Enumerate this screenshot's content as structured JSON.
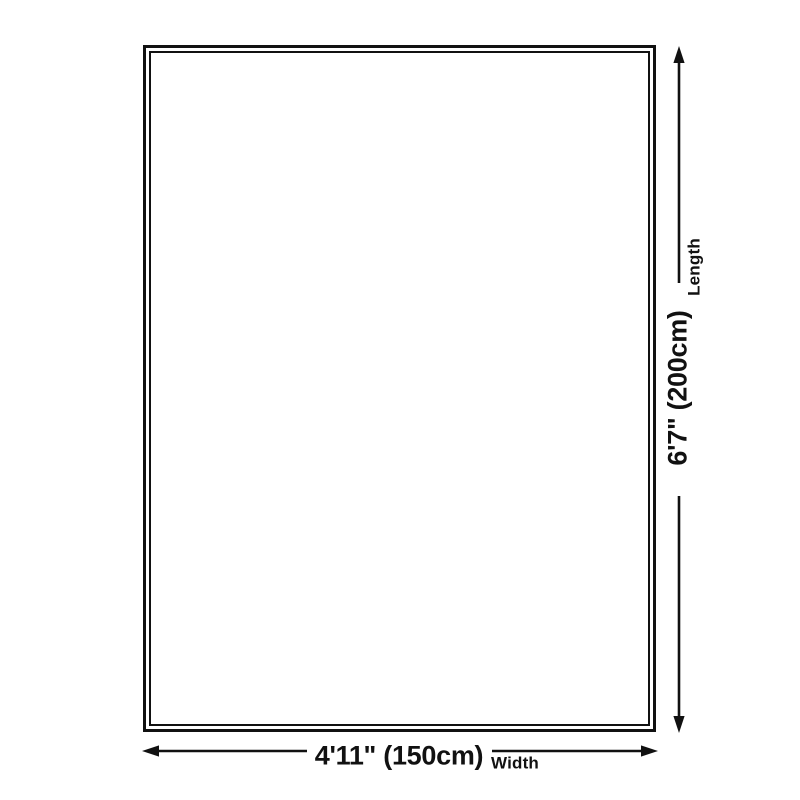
{
  "diagram": {
    "kind": "product-dimension-diagram",
    "dimensions": {
      "length": {
        "value": "6'7\" (200cm)",
        "label": "Length"
      },
      "width": {
        "value": "4'11\" (150cm)",
        "label": "Width"
      }
    },
    "colors": {
      "line": "#111111",
      "background": "#ffffff"
    }
  }
}
